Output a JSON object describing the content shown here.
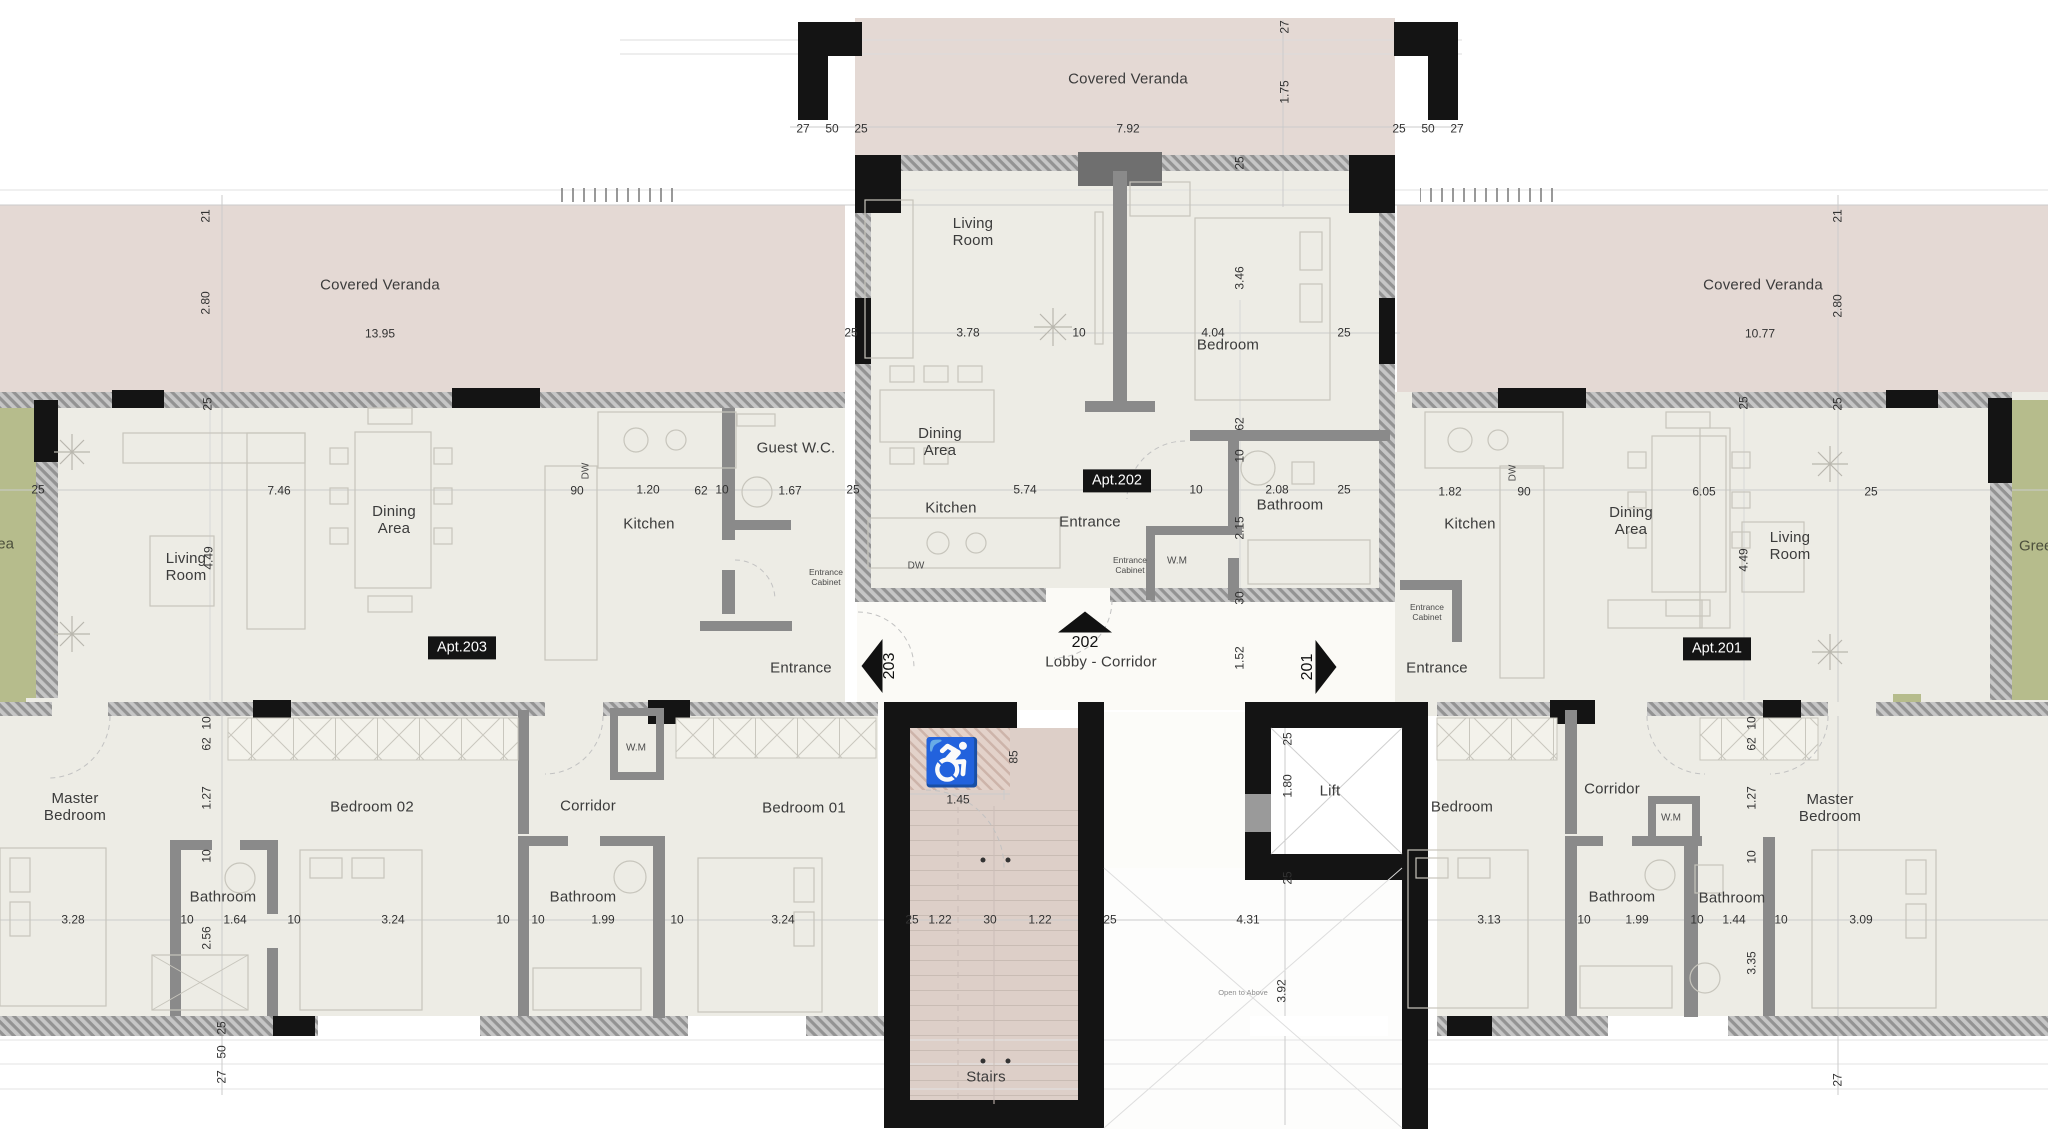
{
  "palette": {
    "veranda": "#e4d9d4",
    "floor": "#edece5",
    "lobby_floor": "#fbfaf6",
    "stairs_floor": "#ddcfc8",
    "green_area": "#b6bc8c",
    "wall_black": "#141414",
    "wall_partition": "#8a8a8a",
    "dim_text": "#323232",
    "badge_bg": "#141414",
    "badge_text": "#ffffff"
  },
  "plan": {
    "apartment_badges": [
      "Apt.203",
      "Apt.202",
      "Apt.201"
    ],
    "unit_arrows": [
      "203",
      "202",
      "201"
    ],
    "labels": [
      {
        "n": "room-label-covered-veranda-center",
        "t": "Covered Veranda",
        "x": 1128,
        "y": 80,
        "c": "room"
      },
      {
        "n": "dim",
        "t": "7.92",
        "x": 1128,
        "y": 129,
        "c": "dim"
      },
      {
        "n": "dim",
        "t": "1.75",
        "x": 1285,
        "y": 92,
        "c": "dimv",
        "r": -90
      },
      {
        "n": "dim",
        "t": "27",
        "x": 1285,
        "y": 27,
        "c": "dimv",
        "r": -90
      },
      {
        "n": "dim",
        "t": "27",
        "x": 803,
        "y": 129,
        "c": "dim"
      },
      {
        "n": "dim",
        "t": "50",
        "x": 832,
        "y": 129,
        "c": "dim"
      },
      {
        "n": "dim",
        "t": "25",
        "x": 861,
        "y": 129,
        "c": "dim"
      },
      {
        "n": "dim",
        "t": "25",
        "x": 1399,
        "y": 129,
        "c": "dim"
      },
      {
        "n": "dim",
        "t": "50",
        "x": 1428,
        "y": 129,
        "c": "dim"
      },
      {
        "n": "dim",
        "t": "27",
        "x": 1457,
        "y": 129,
        "c": "dim"
      },
      {
        "n": "room-label-covered-veranda-left",
        "t": "Covered Veranda",
        "x": 380,
        "y": 286,
        "c": "room"
      },
      {
        "n": "dim",
        "t": "13.95",
        "x": 380,
        "y": 334,
        "c": "dim"
      },
      {
        "n": "dim",
        "t": "2.80",
        "x": 206,
        "y": 303,
        "c": "dimv",
        "r": -90
      },
      {
        "n": "dim",
        "t": "21",
        "x": 206,
        "y": 216,
        "c": "dimv",
        "r": -90
      },
      {
        "n": "dim",
        "t": "25",
        "x": 208,
        "y": 404,
        "c": "dimv",
        "r": -90
      },
      {
        "n": "room-label-covered-veranda-right",
        "t": "Covered Veranda",
        "x": 1763,
        "y": 286,
        "c": "room"
      },
      {
        "n": "dim",
        "t": "10.77",
        "x": 1760,
        "y": 334,
        "c": "dim"
      },
      {
        "n": "dim",
        "t": "2.80",
        "x": 1838,
        "y": 306,
        "c": "dimv",
        "r": -90
      },
      {
        "n": "dim",
        "t": "21",
        "x": 1838,
        "y": 216,
        "c": "dimv",
        "r": -90
      },
      {
        "n": "dim",
        "t": "25",
        "x": 1838,
        "y": 404,
        "c": "dimv",
        "r": -90
      },
      {
        "n": "room-label-living-room-202",
        "t": "Living\nRoom",
        "x": 973,
        "y": 233,
        "c": "room"
      },
      {
        "n": "room-label-bedroom-202",
        "t": "Bedroom",
        "x": 1228,
        "y": 346,
        "c": "room"
      },
      {
        "n": "dim",
        "t": "3.78",
        "x": 968,
        "y": 333,
        "c": "dim"
      },
      {
        "n": "dim",
        "t": "10",
        "x": 1079,
        "y": 333,
        "c": "dim"
      },
      {
        "n": "dim",
        "t": "4.04",
        "x": 1213,
        "y": 333,
        "c": "dim"
      },
      {
        "n": "dim",
        "t": "25",
        "x": 851,
        "y": 333,
        "c": "dim"
      },
      {
        "n": "dim",
        "t": "25",
        "x": 1344,
        "y": 333,
        "c": "dim"
      },
      {
        "n": "dim",
        "t": "3.46",
        "x": 1240,
        "y": 278,
        "c": "dimv",
        "r": -90
      },
      {
        "n": "dim",
        "t": "25",
        "x": 1240,
        "y": 163,
        "c": "dimv",
        "r": -90
      },
      {
        "n": "room-label-dining-area-202",
        "t": "Dining\nArea",
        "x": 940,
        "y": 443,
        "c": "room"
      },
      {
        "n": "room-label-kitchen-202",
        "t": "Kitchen",
        "x": 951,
        "y": 509,
        "c": "room"
      },
      {
        "n": "appliance-label-dw-202",
        "t": "DW",
        "x": 916,
        "y": 566,
        "c": "tiny"
      },
      {
        "n": "badge-apt-202",
        "t": "Apt.202",
        "x": 1117,
        "y": 481,
        "c": "badge"
      },
      {
        "n": "dim",
        "t": "5.74",
        "x": 1025,
        "y": 490,
        "c": "dim"
      },
      {
        "n": "room-label-entrance-202",
        "t": "Entrance",
        "x": 1090,
        "y": 523,
        "c": "room"
      },
      {
        "n": "dim",
        "t": "10",
        "x": 1196,
        "y": 490,
        "c": "dim"
      },
      {
        "n": "dim",
        "t": "2.08",
        "x": 1277,
        "y": 490,
        "c": "dim"
      },
      {
        "n": "dim",
        "t": "25",
        "x": 1344,
        "y": 490,
        "c": "dim"
      },
      {
        "n": "room-label-bathroom-202",
        "t": "Bathroom",
        "x": 1290,
        "y": 506,
        "c": "room"
      },
      {
        "n": "dim",
        "t": "62",
        "x": 1240,
        "y": 424,
        "c": "dimv",
        "r": -90
      },
      {
        "n": "dim",
        "t": "10",
        "x": 1240,
        "y": 456,
        "c": "dimv",
        "r": -90
      },
      {
        "n": "dim",
        "t": "2.15",
        "x": 1240,
        "y": 528,
        "c": "dimv",
        "r": -90
      },
      {
        "n": "dim",
        "t": "30",
        "x": 1240,
        "y": 598,
        "c": "dimv",
        "r": -90
      },
      {
        "n": "appliance-label-wm-202",
        "t": "W.M",
        "x": 1177,
        "y": 561,
        "c": "tiny"
      },
      {
        "n": "label-entrance-cabinet-202",
        "t": "Entrance\nCabinet",
        "x": 1130,
        "y": 566,
        "c": "tiny2"
      },
      {
        "n": "dim",
        "t": "1.52",
        "x": 1240,
        "y": 658,
        "c": "dimv",
        "r": -90
      },
      {
        "n": "room-label-lobby-corridor",
        "t": "Lobby - Corridor",
        "x": 1101,
        "y": 663,
        "c": "room"
      },
      {
        "n": "room-label-entrance-203",
        "t": "Entrance",
        "x": 801,
        "y": 669,
        "c": "room"
      },
      {
        "n": "room-label-entrance-201",
        "t": "Entrance",
        "x": 1437,
        "y": 669,
        "c": "room"
      },
      {
        "n": "room-label-living-room-203",
        "t": "Living\nRoom",
        "x": 186,
        "y": 568,
        "c": "room"
      },
      {
        "n": "dim",
        "t": "4.49",
        "x": 209,
        "y": 558,
        "c": "dimv",
        "r": -90
      },
      {
        "n": "dim",
        "t": "7.46",
        "x": 279,
        "y": 491,
        "c": "dim"
      },
      {
        "n": "room-label-dining-area-203",
        "t": "Dining\nArea",
        "x": 394,
        "y": 521,
        "c": "room"
      },
      {
        "n": "badge-apt-203",
        "t": "Apt.203",
        "x": 462,
        "y": 648,
        "c": "badge"
      },
      {
        "n": "dim",
        "t": "25",
        "x": 38,
        "y": 490,
        "c": "dim"
      },
      {
        "n": "dim",
        "t": "90",
        "x": 577,
        "y": 491,
        "c": "dim"
      },
      {
        "n": "dim",
        "t": "1.20",
        "x": 648,
        "y": 490,
        "c": "dim"
      },
      {
        "n": "dim",
        "t": "62",
        "x": 701,
        "y": 491,
        "c": "dim"
      },
      {
        "n": "dim",
        "t": "10",
        "x": 722,
        "y": 490,
        "c": "dim"
      },
      {
        "n": "room-label-guest-wc-203",
        "t": "Guest W.C.",
        "x": 796,
        "y": 449,
        "c": "room"
      },
      {
        "n": "dim",
        "t": "1.67",
        "x": 790,
        "y": 491,
        "c": "dim"
      },
      {
        "n": "dim",
        "t": "25",
        "x": 853,
        "y": 490,
        "c": "dim"
      },
      {
        "n": "room-label-kitchen-203",
        "t": "Kitchen",
        "x": 649,
        "y": 525,
        "c": "room"
      },
      {
        "n": "appliance-label-dw-203",
        "t": "DW",
        "x": 586,
        "y": 471,
        "c": "tinyv",
        "r": -90
      },
      {
        "n": "label-entrance-cabinet-203",
        "t": "Entrance\nCabinet",
        "x": 826,
        "y": 578,
        "c": "tiny2"
      },
      {
        "n": "room-label-master-bedroom-left",
        "t": "Master\nBedroom",
        "x": 75,
        "y": 808,
        "c": "room"
      },
      {
        "n": "dim",
        "t": "3.28",
        "x": 73,
        "y": 920,
        "c": "dim"
      },
      {
        "n": "dim",
        "t": "10",
        "x": 207,
        "y": 723,
        "c": "dimv",
        "r": -90
      },
      {
        "n": "dim",
        "t": "62",
        "x": 207,
        "y": 744,
        "c": "dimv",
        "r": -90
      },
      {
        "n": "dim",
        "t": "1.27",
        "x": 207,
        "y": 798,
        "c": "dimv",
        "r": -90
      },
      {
        "n": "dim",
        "t": "10",
        "x": 207,
        "y": 856,
        "c": "dimv",
        "r": -90
      },
      {
        "n": "room-label-bedroom-02",
        "t": "Bedroom 02",
        "x": 372,
        "y": 808,
        "c": "room"
      },
      {
        "n": "room-label-bathroom-master-left",
        "t": "Bathroom",
        "x": 223,
        "y": 898,
        "c": "room"
      },
      {
        "n": "dim",
        "t": "10",
        "x": 187,
        "y": 920,
        "c": "dim"
      },
      {
        "n": "dim",
        "t": "1.64",
        "x": 235,
        "y": 920,
        "c": "dim"
      },
      {
        "n": "dim",
        "t": "10",
        "x": 294,
        "y": 920,
        "c": "dim"
      },
      {
        "n": "dim",
        "t": "2.56",
        "x": 207,
        "y": 938,
        "c": "dimv",
        "r": -90
      },
      {
        "n": "dim",
        "t": "3.24",
        "x": 393,
        "y": 920,
        "c": "dim"
      },
      {
        "n": "dim",
        "t": "10",
        "x": 503,
        "y": 920,
        "c": "dim"
      },
      {
        "n": "appliance-label-wm-left",
        "t": "W.M",
        "x": 636,
        "y": 748,
        "c": "tiny"
      },
      {
        "n": "room-label-corridor-left",
        "t": "Corridor",
        "x": 588,
        "y": 807,
        "c": "room"
      },
      {
        "n": "room-label-bathroom-left",
        "t": "Bathroom",
        "x": 583,
        "y": 898,
        "c": "room"
      },
      {
        "n": "dim",
        "t": "10",
        "x": 538,
        "y": 920,
        "c": "dim"
      },
      {
        "n": "dim",
        "t": "1.99",
        "x": 603,
        "y": 920,
        "c": "dim"
      },
      {
        "n": "dim",
        "t": "10",
        "x": 677,
        "y": 920,
        "c": "dim"
      },
      {
        "n": "room-label-bedroom-01",
        "t": "Bedroom 01",
        "x": 804,
        "y": 809,
        "c": "room"
      },
      {
        "n": "dim",
        "t": "3.24",
        "x": 783,
        "y": 920,
        "c": "dim"
      },
      {
        "n": "dim",
        "t": "85",
        "x": 1014,
        "y": 757,
        "c": "dimv",
        "r": -90
      },
      {
        "n": "dim",
        "t": "1.45",
        "x": 958,
        "y": 800,
        "c": "dim"
      },
      {
        "n": "dim",
        "t": "25",
        "x": 912,
        "y": 920,
        "c": "dim"
      },
      {
        "n": "dim",
        "t": "1.22",
        "x": 940,
        "y": 920,
        "c": "dim"
      },
      {
        "n": "dim",
        "t": "30",
        "x": 990,
        "y": 920,
        "c": "dim"
      },
      {
        "n": "dim",
        "t": "1.22",
        "x": 1040,
        "y": 920,
        "c": "dim"
      },
      {
        "n": "dim",
        "t": "25",
        "x": 1110,
        "y": 920,
        "c": "dim"
      },
      {
        "n": "dim",
        "t": "4.31",
        "x": 1248,
        "y": 920,
        "c": "dim"
      },
      {
        "n": "room-label-stairs",
        "t": "Stairs",
        "x": 986,
        "y": 1078,
        "c": "room"
      },
      {
        "n": "room-label-lift",
        "t": "Lift",
        "x": 1330,
        "y": 792,
        "c": "room"
      },
      {
        "n": "dim",
        "t": "25",
        "x": 1288,
        "y": 739,
        "c": "dimv",
        "r": -90
      },
      {
        "n": "dim",
        "t": "1.80",
        "x": 1288,
        "y": 786,
        "c": "dimv",
        "r": -90
      },
      {
        "n": "dim",
        "t": "25",
        "x": 1288,
        "y": 878,
        "c": "dimv",
        "r": -90
      },
      {
        "n": "dim",
        "t": "3.92",
        "x": 1282,
        "y": 991,
        "c": "dimv",
        "r": -90
      },
      {
        "n": "label-open-to-above",
        "t": "Open to Above",
        "x": 1243,
        "y": 993,
        "c": "opento"
      },
      {
        "n": "room-label-bedroom-right",
        "t": "Bedroom",
        "x": 1462,
        "y": 808,
        "c": "room"
      },
      {
        "n": "dim",
        "t": "3.13",
        "x": 1489,
        "y": 920,
        "c": "dim"
      },
      {
        "n": "room-label-corridor-right",
        "t": "Corridor",
        "x": 1612,
        "y": 790,
        "c": "room"
      },
      {
        "n": "appliance-label-wm-right",
        "t": "W.M",
        "x": 1671,
        "y": 818,
        "c": "tiny"
      },
      {
        "n": "dim",
        "t": "10",
        "x": 1752,
        "y": 723,
        "c": "dimv",
        "r": -90
      },
      {
        "n": "dim",
        "t": "62",
        "x": 1752,
        "y": 744,
        "c": "dimv",
        "r": -90
      },
      {
        "n": "dim",
        "t": "1.27",
        "x": 1752,
        "y": 798,
        "c": "dimv",
        "r": -90
      },
      {
        "n": "dim",
        "t": "10",
        "x": 1752,
        "y": 857,
        "c": "dimv",
        "r": -90
      },
      {
        "n": "room-label-master-bedroom-right",
        "t": "Master\nBedroom",
        "x": 1830,
        "y": 809,
        "c": "room"
      },
      {
        "n": "room-label-bathroom-right1",
        "t": "Bathroom",
        "x": 1622,
        "y": 898,
        "c": "room"
      },
      {
        "n": "dim",
        "t": "10",
        "x": 1584,
        "y": 920,
        "c": "dim"
      },
      {
        "n": "dim",
        "t": "1.99",
        "x": 1637,
        "y": 920,
        "c": "dim"
      },
      {
        "n": "dim",
        "t": "10",
        "x": 1697,
        "y": 920,
        "c": "dim"
      },
      {
        "n": "room-label-bathroom-right2",
        "t": "Bathroom",
        "x": 1732,
        "y": 899,
        "c": "room"
      },
      {
        "n": "dim",
        "t": "1.44",
        "x": 1734,
        "y": 920,
        "c": "dim"
      },
      {
        "n": "dim",
        "t": "10",
        "x": 1781,
        "y": 920,
        "c": "dim"
      },
      {
        "n": "dim",
        "t": "3.09",
        "x": 1861,
        "y": 920,
        "c": "dim"
      },
      {
        "n": "dim",
        "t": "3.35",
        "x": 1752,
        "y": 963,
        "c": "dimv",
        "r": -90
      },
      {
        "n": "dim",
        "t": "27",
        "x": 1838,
        "y": 1080,
        "c": "dimv",
        "r": -90
      },
      {
        "n": "room-label-kitchen-201",
        "t": "Kitchen",
        "x": 1470,
        "y": 525,
        "c": "room"
      },
      {
        "n": "dim",
        "t": "1.82",
        "x": 1450,
        "y": 492,
        "c": "dim"
      },
      {
        "n": "appliance-label-dw-201",
        "t": "DW",
        "x": 1513,
        "y": 473,
        "c": "tinyv",
        "r": -90
      },
      {
        "n": "dim",
        "t": "90",
        "x": 1524,
        "y": 492,
        "c": "dim"
      },
      {
        "n": "room-label-dining-area-201",
        "t": "Dining\nArea",
        "x": 1631,
        "y": 522,
        "c": "room"
      },
      {
        "n": "dim",
        "t": "6.05",
        "x": 1704,
        "y": 492,
        "c": "dim"
      },
      {
        "n": "dim",
        "t": "4.49",
        "x": 1744,
        "y": 560,
        "c": "dimv",
        "r": -90
      },
      {
        "n": "room-label-living-room-201",
        "t": "Living\nRoom",
        "x": 1790,
        "y": 547,
        "c": "room"
      },
      {
        "n": "badge-apt-201",
        "t": "Apt.201",
        "x": 1717,
        "y": 649,
        "c": "badge"
      },
      {
        "n": "dim",
        "t": "25",
        "x": 1744,
        "y": 403,
        "c": "dimv",
        "r": -90
      },
      {
        "n": "dim",
        "t": "25",
        "x": 1871,
        "y": 492,
        "c": "dim"
      },
      {
        "n": "label-entrance-cabinet-201",
        "t": "Entrance\nCabinet",
        "x": 1427,
        "y": 613,
        "c": "tiny2"
      },
      {
        "n": "room-label-green-area-right",
        "t": "Green Area",
        "x": 2019,
        "y": 547,
        "c": "green",
        "a": "l"
      },
      {
        "n": "room-label-green-area-left",
        "t": "Green Area",
        "x": 14,
        "y": 545,
        "c": "green",
        "a": "r"
      },
      {
        "n": "dim",
        "t": "25",
        "x": 222,
        "y": 1028,
        "c": "dimv",
        "r": -90
      },
      {
        "n": "dim",
        "t": "50",
        "x": 222,
        "y": 1052,
        "c": "dimv",
        "r": -90
      },
      {
        "n": "dim",
        "t": "27",
        "x": 222,
        "y": 1077,
        "c": "dimv",
        "r": -90
      }
    ],
    "arrows": [
      {
        "n": "arrow-unit-202",
        "dir": "up",
        "label": "202",
        "x": 1085,
        "y": 622
      },
      {
        "n": "arrow-unit-203",
        "dir": "left",
        "label": "203",
        "x": 872,
        "y": 666
      },
      {
        "n": "arrow-unit-201",
        "dir": "right",
        "label": "201",
        "x": 1326,
        "y": 667
      }
    ],
    "icons": {
      "wheelchair": {
        "glyph": "♿",
        "x": 952,
        "y": 762
      }
    }
  }
}
